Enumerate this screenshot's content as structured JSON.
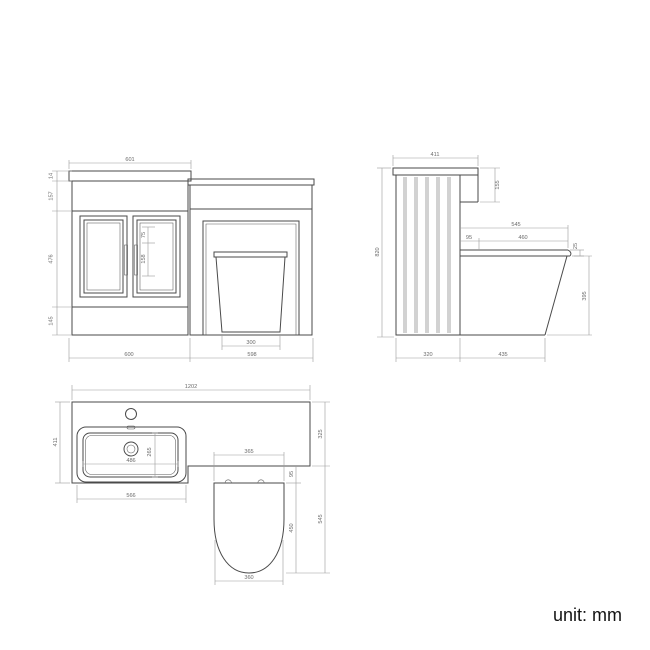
{
  "unit_label": "unit: mm",
  "front_view": {
    "width_top": "601",
    "worktop_thickness": "14",
    "upper_band_height": "157",
    "door_height": "476",
    "plinth_height": "145",
    "vanity_width_bottom": "600",
    "wc_unit_width_bottom": "598",
    "pan_base_width": "300",
    "handle_offset": "75",
    "handle_length": "158"
  },
  "side_view": {
    "top_depth": "411",
    "side_panel_drop": "155",
    "total_height": "820",
    "seat_overall_depth": "545",
    "seat_back_gap": "95",
    "seat_length": "460",
    "seat_thickness": "25",
    "pan_height": "395",
    "cistern_unit_depth": "320",
    "pan_projection": "435"
  },
  "plan_view": {
    "total_width": "1202",
    "vanity_depth": "411",
    "worktop_depth": "325",
    "wc_section_depth": "545",
    "seat_hinge_offset": "95",
    "seat_length": "450",
    "basin_inner_width": "486",
    "basin_inner_depth": "265",
    "basin_outer_width": "566",
    "seat_width_top": "365",
    "seat_width_bottom": "360"
  }
}
